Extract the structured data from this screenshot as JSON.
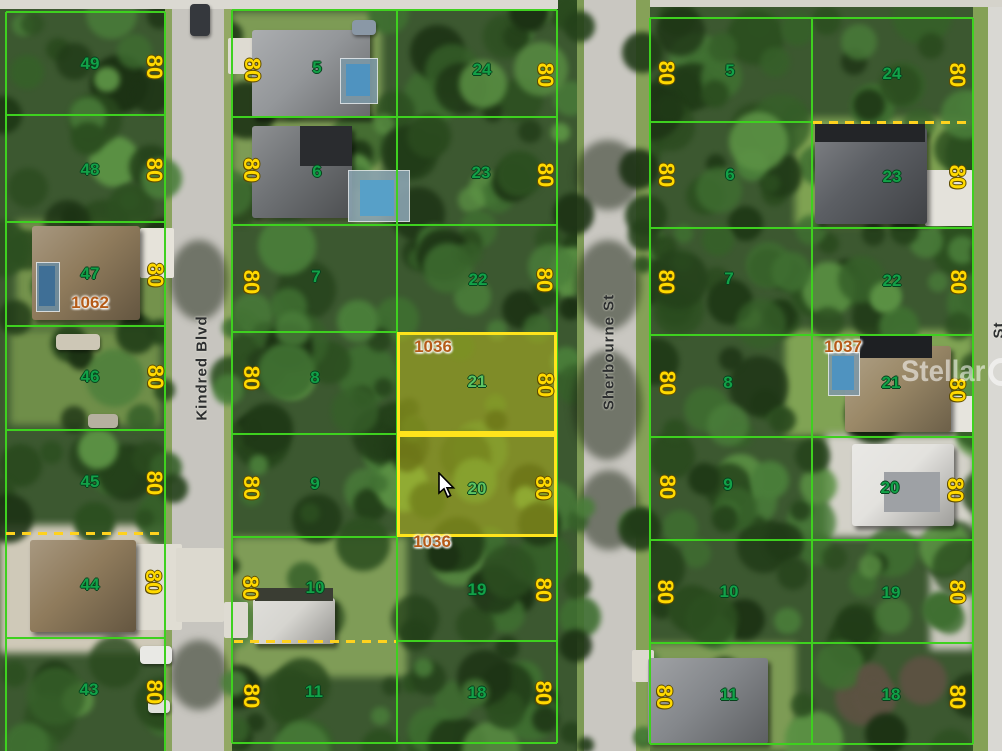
{
  "canvas": {
    "width": 1002,
    "height": 751
  },
  "watermark": {
    "brand_left": "Stellar",
    "brand_right": "MLS"
  },
  "dimension_text": "80",
  "highlighted_lot_numbers": [
    "21",
    "20"
  ],
  "highlighted_parcel_id": "1036",
  "streets": [
    {
      "id": "kindred-blvd",
      "label": "Kindred Blvd",
      "cx": 202,
      "cy": 368
    },
    {
      "id": "sherbourne-st",
      "label": "Sherbourne St",
      "cx": 609,
      "cy": 352
    },
    {
      "id": "right-street-partial",
      "label": "St",
      "cx": 999,
      "cy": 330
    }
  ],
  "parcel_ids": [
    {
      "text": "1062",
      "cx": 90,
      "cy": 303
    },
    {
      "text": "1036",
      "cx": 433,
      "cy": 347
    },
    {
      "text": "1036",
      "cx": 432,
      "cy": 542
    },
    {
      "text": "1037",
      "cx": 843,
      "cy": 347
    }
  ],
  "lots": [
    {
      "block": "west",
      "n": "49",
      "nx": 90,
      "ny": 64,
      "dx": 154,
      "dy": 67
    },
    {
      "block": "west",
      "n": "48",
      "nx": 90,
      "ny": 170,
      "dx": 154,
      "dy": 170
    },
    {
      "block": "west",
      "n": "47",
      "nx": 90,
      "ny": 274,
      "dx": 155,
      "dy": 275
    },
    {
      "block": "west",
      "n": "46",
      "nx": 90,
      "ny": 377,
      "dx": 155,
      "dy": 377
    },
    {
      "block": "west",
      "n": "45",
      "nx": 90,
      "ny": 482,
      "dx": 154,
      "dy": 483
    },
    {
      "block": "west",
      "n": "44",
      "nx": 90,
      "ny": 585,
      "dx": 153,
      "dy": 582
    },
    {
      "block": "west",
      "n": "43",
      "nx": 89,
      "ny": 690,
      "dx": 154,
      "dy": 692
    },
    {
      "block": "mid",
      "n": "5",
      "nx": 317,
      "ny": 68,
      "dx": 252,
      "dy": 70
    },
    {
      "block": "mid",
      "n": "6",
      "nx": 317,
      "ny": 172,
      "dx": 251,
      "dy": 170
    },
    {
      "block": "mid",
      "n": "7",
      "nx": 316,
      "ny": 277,
      "dx": 251,
      "dy": 282
    },
    {
      "block": "mid",
      "n": "8",
      "nx": 315,
      "ny": 378,
      "dx": 251,
      "dy": 378
    },
    {
      "block": "mid",
      "n": "9",
      "nx": 315,
      "ny": 484,
      "dx": 251,
      "dy": 488
    },
    {
      "block": "mid",
      "n": "10",
      "nx": 315,
      "ny": 588,
      "dx": 250,
      "dy": 588
    },
    {
      "block": "mid",
      "n": "11",
      "nx": 314,
      "ny": 692,
      "dx": 251,
      "dy": 696
    },
    {
      "block": "mid",
      "n": "24",
      "nx": 482,
      "ny": 70,
      "dx": 545,
      "dy": 75
    },
    {
      "block": "mid",
      "n": "23",
      "nx": 481,
      "ny": 173,
      "dx": 545,
      "dy": 175
    },
    {
      "block": "mid",
      "n": "22",
      "nx": 478,
      "ny": 280,
      "dx": 544,
      "dy": 280
    },
    {
      "block": "mid",
      "n": "21",
      "nx": 477,
      "ny": 382,
      "dx": 545,
      "dy": 385,
      "hl": true
    },
    {
      "block": "mid",
      "n": "20",
      "nx": 477,
      "ny": 489,
      "dx": 543,
      "dy": 488,
      "hl": true
    },
    {
      "block": "mid",
      "n": "19",
      "nx": 477,
      "ny": 590,
      "dx": 543,
      "dy": 590
    },
    {
      "block": "mid",
      "n": "18",
      "nx": 477,
      "ny": 693,
      "dx": 543,
      "dy": 693
    },
    {
      "block": "east",
      "n": "5",
      "nx": 730,
      "ny": 71,
      "dx": 666,
      "dy": 73
    },
    {
      "block": "east",
      "n": "6",
      "nx": 730,
      "ny": 175,
      "dx": 666,
      "dy": 175
    },
    {
      "block": "east",
      "n": "7",
      "nx": 729,
      "ny": 279,
      "dx": 666,
      "dy": 282
    },
    {
      "block": "east",
      "n": "8",
      "nx": 728,
      "ny": 383,
      "dx": 667,
      "dy": 383
    },
    {
      "block": "east",
      "n": "9",
      "nx": 728,
      "ny": 485,
      "dx": 667,
      "dy": 487
    },
    {
      "block": "east",
      "n": "10",
      "nx": 729,
      "ny": 592,
      "dx": 665,
      "dy": 592
    },
    {
      "block": "east",
      "n": "11",
      "nx": 729,
      "ny": 695,
      "dx": 664,
      "dy": 697
    },
    {
      "block": "east",
      "n": "24",
      "nx": 892,
      "ny": 74,
      "dx": 957,
      "dy": 75
    },
    {
      "block": "east",
      "n": "23",
      "nx": 892,
      "ny": 177,
      "dx": 957,
      "dy": 177
    },
    {
      "block": "east",
      "n": "22",
      "nx": 892,
      "ny": 281,
      "dx": 958,
      "dy": 282
    },
    {
      "block": "east",
      "n": "21",
      "nx": 891,
      "ny": 383,
      "dx": 957,
      "dy": 390
    },
    {
      "block": "east",
      "n": "20",
      "nx": 890,
      "ny": 488,
      "dx": 955,
      "dy": 490
    },
    {
      "block": "east",
      "n": "19",
      "nx": 891,
      "ny": 593,
      "dx": 957,
      "dy": 592
    },
    {
      "block": "east",
      "n": "18",
      "nx": 891,
      "ny": 695,
      "dx": 957,
      "dy": 697
    }
  ],
  "highlight_rects": [
    {
      "x": 397,
      "y": 332,
      "w": 160,
      "h": 102
    },
    {
      "x": 397,
      "y": 434,
      "w": 160,
      "h": 103
    }
  ],
  "lines": {
    "v": [
      {
        "x": 6,
        "y0": 12,
        "y1": 751
      },
      {
        "x": 165,
        "y0": 12,
        "y1": 751
      },
      {
        "x": 232,
        "y0": 10,
        "y1": 743
      },
      {
        "x": 397,
        "y0": 10,
        "y1": 743
      },
      {
        "x": 557,
        "y0": 10,
        "y1": 743
      },
      {
        "x": 650,
        "y0": 18,
        "y1": 744
      },
      {
        "x": 812,
        "y0": 18,
        "y1": 744
      },
      {
        "x": 973,
        "y0": 18,
        "y1": 744
      }
    ],
    "h": [
      {
        "y": 12,
        "x0": 6,
        "x1": 165
      },
      {
        "y": 115,
        "x0": 6,
        "x1": 165
      },
      {
        "y": 222,
        "x0": 6,
        "x1": 165
      },
      {
        "y": 326,
        "x0": 6,
        "x1": 165
      },
      {
        "y": 430,
        "x0": 6,
        "x1": 165
      },
      {
        "y": 638,
        "x0": 6,
        "x1": 165
      },
      {
        "y": 10,
        "x0": 232,
        "x1": 557
      },
      {
        "y": 117,
        "x0": 232,
        "x1": 557
      },
      {
        "y": 225,
        "x0": 232,
        "x1": 557
      },
      {
        "y": 332,
        "x0": 232,
        "x1": 397
      },
      {
        "y": 434,
        "x0": 232,
        "x1": 397
      },
      {
        "y": 537,
        "x0": 232,
        "x1": 397
      },
      {
        "y": 641,
        "x0": 397,
        "x1": 557
      },
      {
        "y": 743,
        "x0": 232,
        "x1": 557
      },
      {
        "y": 18,
        "x0": 650,
        "x1": 973
      },
      {
        "y": 122,
        "x0": 650,
        "x1": 812
      },
      {
        "y": 228,
        "x0": 650,
        "x1": 973
      },
      {
        "y": 335,
        "x0": 650,
        "x1": 973
      },
      {
        "y": 437,
        "x0": 650,
        "x1": 973
      },
      {
        "y": 540,
        "x0": 650,
        "x1": 973
      },
      {
        "y": 643,
        "x0": 650,
        "x1": 973
      },
      {
        "y": 744,
        "x0": 650,
        "x1": 973
      }
    ]
  },
  "dashed_lines": [
    {
      "x0": 6,
      "x1": 165,
      "y": 533
    },
    {
      "x0": 234,
      "x1": 396,
      "y": 641
    },
    {
      "x0": 813,
      "x1": 972,
      "y": 122
    }
  ],
  "features": {
    "lawns": [
      {
        "x": 232,
        "y": 12,
        "w": 150,
        "h": 210,
        "c": "#7d9b55"
      },
      {
        "x": 795,
        "y": 118,
        "w": 178,
        "h": 108,
        "c": "#7fa252"
      },
      {
        "x": 785,
        "y": 330,
        "w": 188,
        "h": 106,
        "c": "#80a354"
      },
      {
        "x": 232,
        "y": 537,
        "w": 175,
        "h": 140,
        "c": "#7f9c57"
      },
      {
        "x": 636,
        "y": 643,
        "w": 160,
        "h": 108,
        "c": "#7d9b55"
      },
      {
        "x": 16,
        "y": 220,
        "w": 152,
        "h": 108,
        "c": "#74924c"
      },
      {
        "x": 10,
        "y": 330,
        "w": 150,
        "h": 95,
        "c": "#6f8e49"
      }
    ],
    "grounds": [
      {
        "x": 0,
        "y": 525,
        "w": 168,
        "h": 128,
        "c": "#cfc9b8"
      },
      {
        "x": 826,
        "y": 434,
        "w": 148,
        "h": 103,
        "c": "#d3d1c8"
      },
      {
        "x": 930,
        "y": 560,
        "w": 44,
        "h": 90,
        "c": "#c9c7bd"
      }
    ],
    "roads": [
      {
        "x": 165,
        "y": 0,
        "w": 7,
        "h": 751,
        "c": "#8aa35e"
      },
      {
        "x": 172,
        "y": 0,
        "w": 52,
        "h": 751,
        "c": "#c7c5bf"
      },
      {
        "x": 224,
        "y": 0,
        "w": 8,
        "h": 751,
        "c": "#93a864"
      },
      {
        "x": 577,
        "y": 0,
        "w": 7,
        "h": 751,
        "c": "#7d9a55"
      },
      {
        "x": 584,
        "y": 0,
        "w": 52,
        "h": 751,
        "c": "#c9c7c1"
      },
      {
        "x": 636,
        "y": 0,
        "w": 14,
        "h": 751,
        "c": "#86a158"
      },
      {
        "x": 973,
        "y": 0,
        "w": 15,
        "h": 751,
        "c": "#84a156"
      },
      {
        "x": 988,
        "y": 0,
        "w": 14,
        "h": 751,
        "c": "#d9d8d3"
      },
      {
        "x": 0,
        "y": 0,
        "w": 558,
        "h": 9,
        "c": "#dbd9d2"
      },
      {
        "x": 650,
        "y": 0,
        "w": 352,
        "h": 7,
        "c": "#d5d3cb"
      }
    ],
    "driveways": [
      {
        "x": 140,
        "y": 228,
        "w": 34,
        "h": 50,
        "c": "#e6e3da"
      },
      {
        "x": 136,
        "y": 544,
        "w": 46,
        "h": 86,
        "c": "#e0ddd3"
      },
      {
        "x": 176,
        "y": 548,
        "w": 48,
        "h": 74,
        "c": "#dcd9cf"
      },
      {
        "x": 925,
        "y": 170,
        "w": 48,
        "h": 56,
        "c": "#e4e2db"
      },
      {
        "x": 946,
        "y": 396,
        "w": 28,
        "h": 36,
        "c": "#e6e4dd"
      },
      {
        "x": 228,
        "y": 38,
        "w": 26,
        "h": 36,
        "c": "#dedbd2"
      },
      {
        "x": 224,
        "y": 602,
        "w": 24,
        "h": 36,
        "c": "#dedbd2"
      },
      {
        "x": 632,
        "y": 650,
        "w": 22,
        "h": 32,
        "c": "#dcd9cf"
      }
    ],
    "houses": [
      {
        "x": 252,
        "y": 30,
        "w": 118,
        "h": 88,
        "c": "#94979a"
      },
      {
        "x": 252,
        "y": 126,
        "w": 100,
        "h": 92,
        "c": "#6e7174"
      },
      {
        "x": 32,
        "y": 226,
        "w": 108,
        "h": 94,
        "c": "#8f7b5c"
      },
      {
        "x": 30,
        "y": 540,
        "w": 106,
        "h": 92,
        "c": "#8f7b5c"
      },
      {
        "x": 815,
        "y": 128,
        "w": 112,
        "h": 96,
        "c": "#5b5e63"
      },
      {
        "x": 845,
        "y": 346,
        "w": 106,
        "h": 86,
        "c": "#9b8968"
      },
      {
        "x": 852,
        "y": 444,
        "w": 102,
        "h": 82,
        "c": "#e3e2de"
      },
      {
        "x": 253,
        "y": 598,
        "w": 82,
        "h": 46,
        "c": "#d6d5d0"
      },
      {
        "x": 648,
        "y": 658,
        "w": 120,
        "h": 86,
        "c": "#85888c"
      }
    ],
    "house_darks": [
      {
        "x": 860,
        "y": 334,
        "w": 72,
        "h": 24,
        "c": "#1e2023"
      },
      {
        "x": 300,
        "y": 126,
        "w": 52,
        "h": 40,
        "c": "#2a2c2f"
      },
      {
        "x": 255,
        "y": 588,
        "w": 78,
        "h": 13,
        "c": "#3a3d33"
      },
      {
        "x": 815,
        "y": 124,
        "w": 110,
        "h": 18,
        "c": "#232528"
      },
      {
        "x": 884,
        "y": 472,
        "w": 56,
        "h": 40,
        "c": "#9ea1a5"
      }
    ],
    "pools": [
      {
        "x": 340,
        "y": 58,
        "w": 36,
        "h": 44,
        "cage": "#7d98a6",
        "wx": 346,
        "wy": 64,
        "ww": 24,
        "wh": 32,
        "water": "#4f93c0"
      },
      {
        "x": 348,
        "y": 170,
        "w": 60,
        "h": 50,
        "cage": "#8aa3b0",
        "wx": 360,
        "wy": 180,
        "ww": 34,
        "wh": 36,
        "water": "#57a0c8"
      },
      {
        "x": 36,
        "y": 262,
        "w": 22,
        "h": 48,
        "cage": "#6d8da0",
        "wx": 39,
        "wy": 266,
        "ww": 16,
        "wh": 40,
        "water": "#3f6f96"
      },
      {
        "x": 828,
        "y": 352,
        "w": 30,
        "h": 42,
        "cage": "#7f98a6",
        "wx": 832,
        "wy": 356,
        "ww": 22,
        "wh": 34,
        "water": "#4f93c0"
      }
    ],
    "cars": [
      {
        "x": 190,
        "y": 4,
        "w": 20,
        "h": 32,
        "c": "#35383d"
      },
      {
        "x": 352,
        "y": 20,
        "w": 24,
        "h": 15,
        "c": "#8a98a6"
      },
      {
        "x": 140,
        "y": 646,
        "w": 32,
        "h": 18,
        "c": "#e9e9e5"
      },
      {
        "x": 148,
        "y": 700,
        "w": 22,
        "h": 13,
        "c": "#e0e1db"
      },
      {
        "x": 56,
        "y": 334,
        "w": 44,
        "h": 16,
        "c": "#cdc7b6"
      },
      {
        "x": 88,
        "y": 414,
        "w": 30,
        "h": 14,
        "c": "#b6b0a0"
      }
    ],
    "road_shadows": [
      {
        "x": 575,
        "y": 140,
        "w": 66,
        "h": 70
      },
      {
        "x": 575,
        "y": 240,
        "w": 66,
        "h": 90
      },
      {
        "x": 572,
        "y": 350,
        "w": 70,
        "h": 110
      },
      {
        "x": 578,
        "y": 470,
        "w": 62,
        "h": 80
      },
      {
        "x": 170,
        "y": 240,
        "w": 58,
        "h": 80
      },
      {
        "x": 170,
        "y": 640,
        "w": 58,
        "h": 70
      }
    ]
  },
  "foliage": {
    "seed": 7,
    "count": 540,
    "palette": [
      "#1c3214",
      "#24411a",
      "#2c4f20",
      "#366029",
      "#3f6f31",
      "#4a7e3a",
      "#203a17",
      "#2a4a1e"
    ],
    "accent": "#5b9144",
    "brown": "#5c5242",
    "skip": [
      [
        170,
        0,
        56,
        751
      ],
      [
        582,
        0,
        56,
        751
      ],
      [
        986,
        0,
        16,
        751
      ],
      [
        0,
        0,
        1002,
        9
      ],
      [
        0,
        523,
        168,
        130
      ],
      [
        824,
        432,
        152,
        106
      ]
    ],
    "sparse": [
      [
        232,
        12,
        150,
        210
      ],
      [
        795,
        118,
        178,
        108
      ],
      [
        785,
        330,
        188,
        106
      ],
      [
        232,
        537,
        175,
        140
      ],
      [
        636,
        643,
        160,
        108
      ],
      [
        16,
        220,
        152,
        108
      ]
    ],
    "debris": [
      840,
      645,
      130,
      100
    ]
  },
  "colors": {
    "lot_line": "#3ed11f",
    "highlight_border": "#ffe41c",
    "highlight_fill": "rgba(222,212,30,0.42)",
    "lot_number": "#12a148",
    "lot_number_highlighted": "#5cc463",
    "dimension": "#ffd900",
    "parcel_id": "#b55b18",
    "dashed": "#ffd21e",
    "street_text": "#2c2e2f"
  }
}
